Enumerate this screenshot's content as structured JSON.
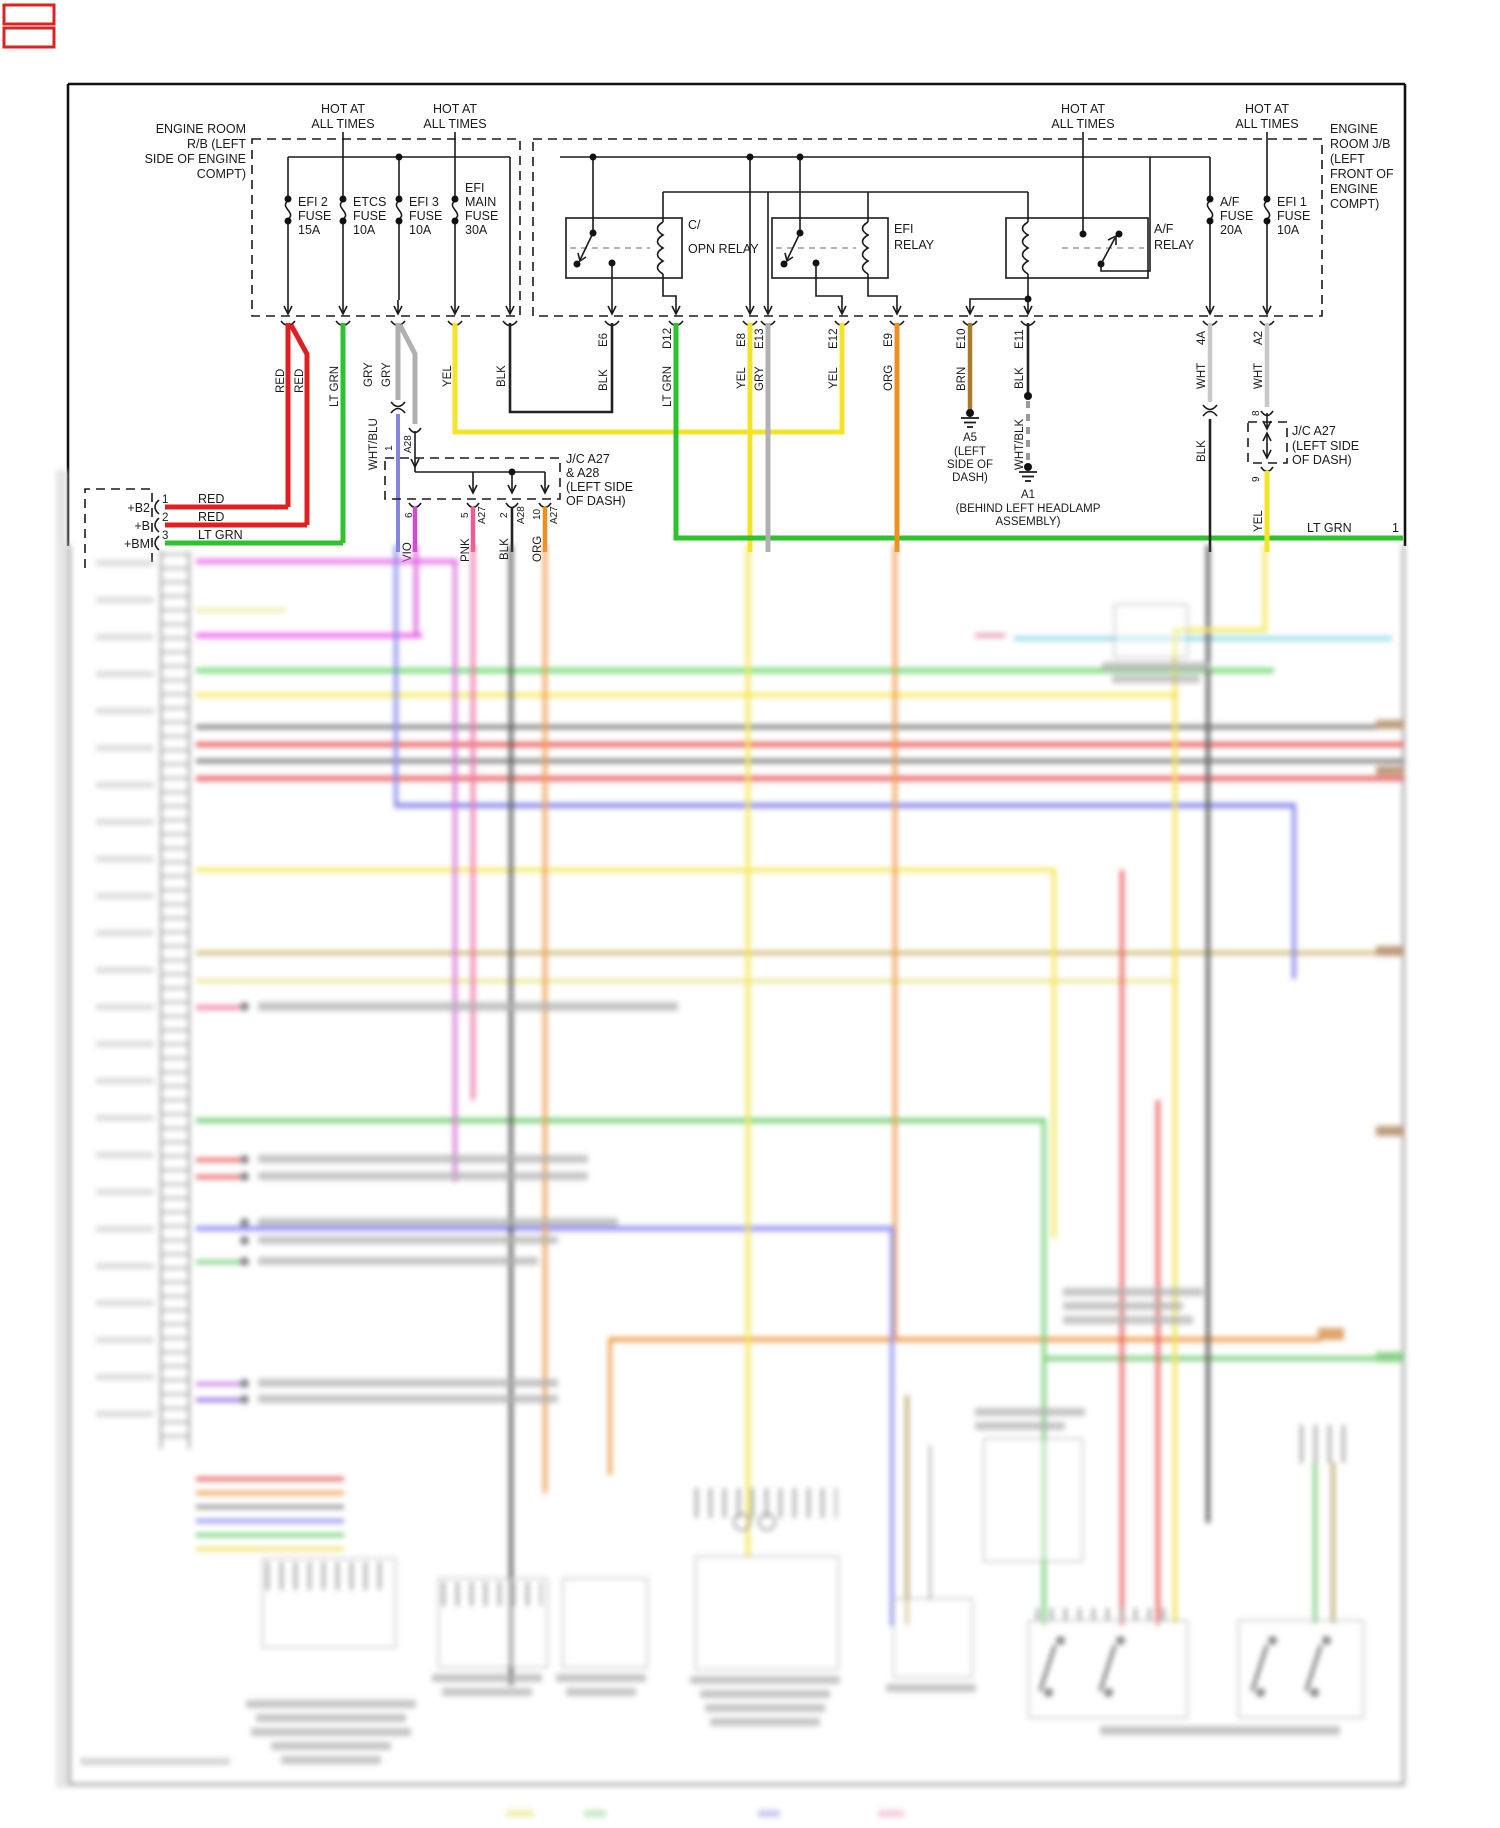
{
  "diagram": {
    "hot_labels": [
      {
        "l1": "HOT AT",
        "l2": "ALL TIMES"
      },
      {
        "l1": "HOT AT",
        "l2": "ALL TIMES"
      },
      {
        "l1": "HOT AT",
        "l2": "ALL TIMES"
      },
      {
        "l1": "HOT AT",
        "l2": "ALL TIMES"
      }
    ],
    "rb_box": {
      "lines": [
        "ENGINE ROOM",
        "R/B (LEFT",
        "SIDE OF ENGINE",
        "COMPT)"
      ]
    },
    "jb_box": {
      "lines": [
        "ENGINE",
        "ROOM J/B",
        "(LEFT",
        "FRONT OF",
        "ENGINE",
        "COMPT)"
      ]
    },
    "fuses": [
      {
        "lines": [
          "EFI 2",
          "FUSE",
          "15A"
        ]
      },
      {
        "lines": [
          "ETCS",
          "FUSE",
          "10A"
        ]
      },
      {
        "lines": [
          "EFI 3",
          "FUSE",
          "10A"
        ]
      },
      {
        "lines": [
          "EFI",
          "MAIN",
          "FUSE",
          "30A"
        ]
      },
      {
        "lines": [
          "A/F",
          "FUSE",
          "20A"
        ]
      },
      {
        "lines": [
          "EFI 1",
          "FUSE",
          "10A"
        ]
      }
    ],
    "relays": [
      {
        "lines": [
          "C/",
          "OPN RELAY"
        ]
      },
      {
        "lines": [
          "EFI",
          "RELAY"
        ]
      },
      {
        "lines": [
          "A/F",
          "RELAY"
        ]
      }
    ],
    "exits": {
      "ids": [
        "E6",
        "D12",
        "E8",
        "E13",
        "E12",
        "E9",
        "E10",
        "E11",
        "4A",
        "A2"
      ]
    },
    "wire_colors": {
      "red": "RED",
      "lt_grn": "LT GRN",
      "gry": "GRY",
      "wht_blu": "WHT/BLU",
      "yel": "YEL",
      "blk": "BLK",
      "org": "ORG",
      "brn": "BRN",
      "wht": "WHT",
      "wht_blk": "WHT/BLK",
      "vio": "VIO",
      "pnk": "PNK"
    },
    "jc_a27_a28": {
      "lines": [
        "J/C A27",
        "& A28",
        "(LEFT SIDE",
        "OF DASH)"
      ],
      "entry_pin": "1",
      "entry_conn": "A28",
      "pins": [
        "6",
        "5",
        "2",
        "10"
      ],
      "pin_conns": [
        "A27",
        "A28",
        "A27"
      ]
    },
    "jc_a27": {
      "lines": [
        "J/C A27",
        "(LEFT SIDE",
        "OF DASH)"
      ],
      "top_pin": "8",
      "bottom_pin": "9"
    },
    "grounds": {
      "a5": {
        "id": "A5",
        "lines": [
          "(LEFT",
          "SIDE OF",
          "DASH)"
        ]
      },
      "a1": {
        "id": "A1",
        "lines": [
          "(BEHIND LEFT HEADLAMP",
          "ASSEMBLY)"
        ]
      }
    },
    "ecm": {
      "pins": [
        {
          "name": "+B2",
          "num": "1",
          "color": "RED"
        },
        {
          "name": "+B",
          "num": "2",
          "color": "RED"
        },
        {
          "name": "+BM",
          "num": "3",
          "color": "LT GRN"
        }
      ]
    },
    "right_exit": {
      "color": "LT GRN",
      "pin": "1"
    },
    "palette": {
      "red": "#e02020",
      "lt_grn": "#2ec22e",
      "gry": "#b0b0b0",
      "wht_blu": "#8585e0",
      "yel": "#f5e32a",
      "blk": "#222222",
      "org": "#ef8f1f",
      "brn": "#a97b28",
      "wht": "#c8c8c8",
      "vio": "#d24ad2",
      "pnk": "#ea5c92"
    }
  }
}
